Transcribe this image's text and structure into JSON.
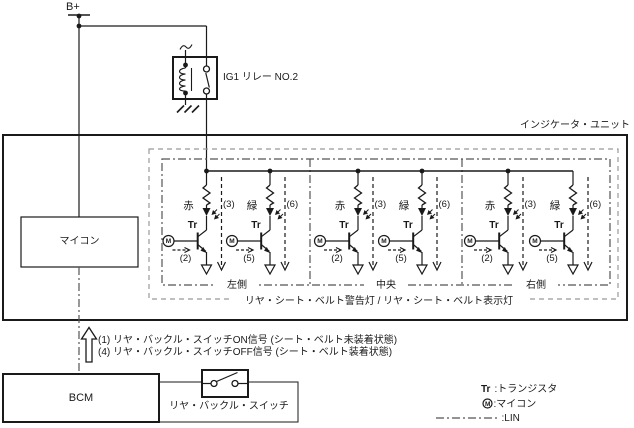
{
  "power": {
    "label": "B+"
  },
  "relay": {
    "label": "IG1 リレー NO.2"
  },
  "unit": {
    "title": "インジケータ・ユニット",
    "caption": "リヤ・シート・ベルト警告灯 / リヤ・シート・ベルト表示灯"
  },
  "micom": {
    "label": "マイコン"
  },
  "sections": [
    {
      "label": "左側"
    },
    {
      "label": "中央"
    },
    {
      "label": "右側"
    }
  ],
  "cells": [
    {
      "color": "赤",
      "tr": "Tr",
      "m": "M",
      "base": "(2)",
      "sense": "(3)"
    },
    {
      "color": "緑",
      "tr": "Tr",
      "m": "M",
      "base": "(5)",
      "sense": "(6)"
    },
    {
      "color": "赤",
      "tr": "Tr",
      "m": "M",
      "base": "(2)",
      "sense": "(3)"
    },
    {
      "color": "緑",
      "tr": "Tr",
      "m": "M",
      "base": "(5)",
      "sense": "(6)"
    },
    {
      "color": "赤",
      "tr": "Tr",
      "m": "M",
      "base": "(2)",
      "sense": "(3)"
    },
    {
      "color": "緑",
      "tr": "Tr",
      "m": "M",
      "base": "(5)",
      "sense": "(6)"
    }
  ],
  "signals": {
    "line1": "(1) リヤ・バックル・スイッチON信号 (シート・ベルト未装着状態)",
    "line2": "(4) リヤ・バックル・スイッチOFF信号 (シート・ベルト装着状態)"
  },
  "bcm": {
    "label": "BCM",
    "switch_label": "リヤ・バックル・スイッチ"
  },
  "legend": {
    "tr_term": "Tr",
    "tr_desc": ":トランジスタ",
    "m_term": "M",
    "m_desc": ":マイコン",
    "lin_desc": ":LIN"
  },
  "colors": {
    "line": "#1a1a1a",
    "dashed_border": "#999999",
    "dashdot_border": "#555555",
    "background": "#ffffff"
  }
}
